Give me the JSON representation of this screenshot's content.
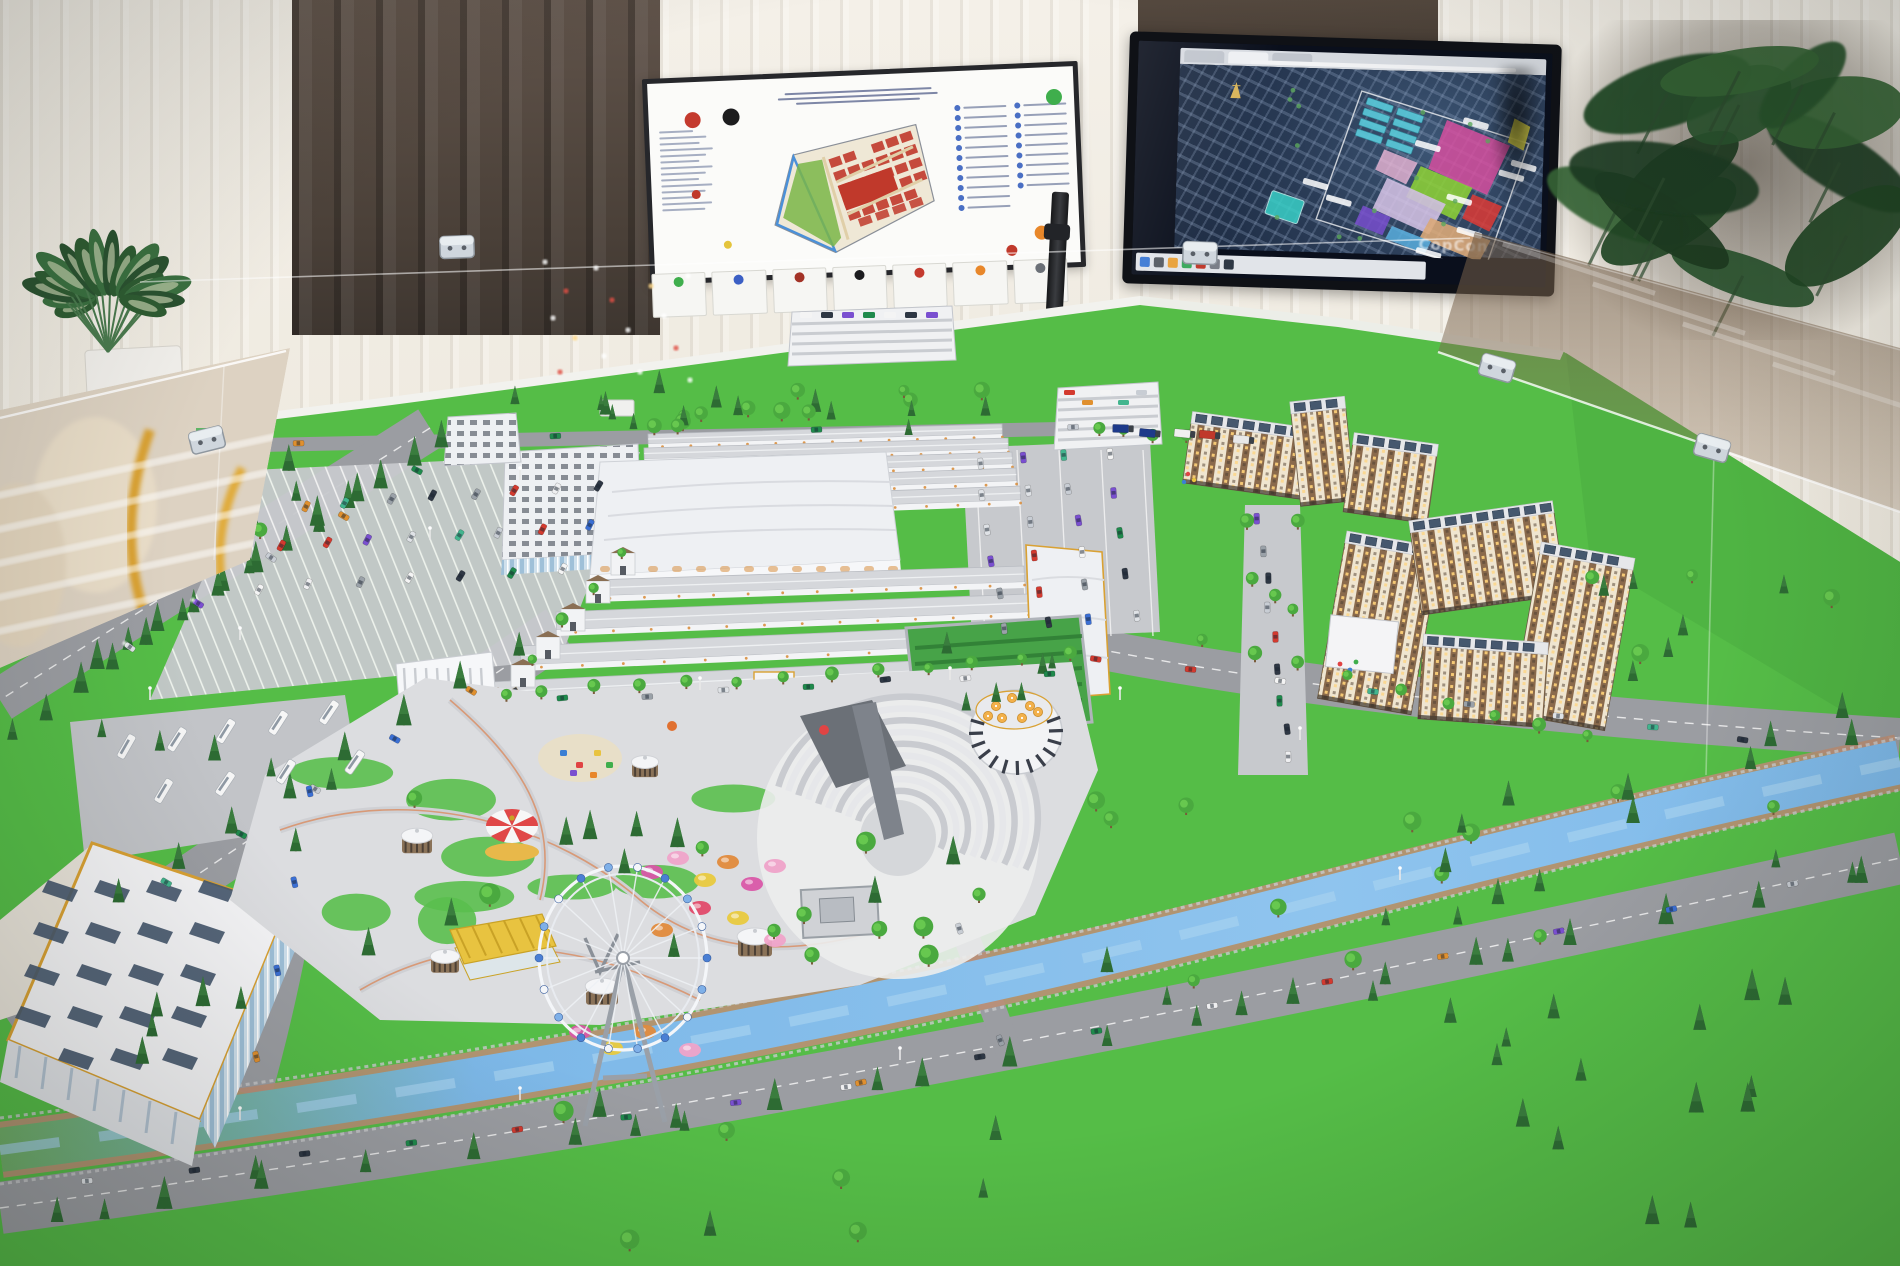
{
  "scene": {
    "subject": "Architectural scale model of a large bazaar / market complex with amusement park, apartment blocks and office building, displayed on a table behind glass barriers",
    "setting": "Showroom with cream pleated curtains, a brown drape, a printed master-plan board on an easel and a TV showing an aerial master plan"
  },
  "colors": {
    "grass": "#55bd47",
    "grassDark": "#3f9e3c",
    "rim": "#f2f2ed",
    "road": "#9b9da2",
    "roadLight": "#b2b4b8",
    "pave": "#dcdde0",
    "canal": "#7db8e8",
    "canalLight": "#aondefined",
    "canalHi": "#a8d2f0",
    "canalWall": "#bb8f75",
    "roof": "#d5d7db",
    "roofEdge": "#b9bcc2",
    "hall": "#eef0f3",
    "aptCream": "#efe5d0",
    "aptBrown": "#8a6a4c",
    "windowLit": "#ffd37a",
    "solar": "#46586e",
    "treeRound": "#4aa93f",
    "treeConifer": "#2d6b33",
    "gold": "#d9a133",
    "umbrella": "#f2b04a",
    "fence": "#c9ccd2",
    "archAccent": "#d98f3f"
  },
  "board": {
    "title_line_widths": [
      210,
      228,
      178
    ],
    "stamps": {
      "red": "#c43a2e",
      "black": "#1c1c1e",
      "green": "#3fae4c",
      "orange": "#e8872a",
      "yellow": "#e4c43c",
      "small_red": "#c0392b"
    },
    "left_text_rows": 14,
    "legend_rows_left": 11,
    "legend_rows_right": 9,
    "cards": [
      {
        "dot": "#3fae4c"
      },
      {
        "dot": "#3b5fc4"
      },
      {
        "dot": "#a33327"
      },
      {
        "dot": "#1c1c1e"
      },
      {
        "dot": "#c43a2e"
      },
      {
        "dot": "#e8872a"
      },
      {
        "dot": "#6b7077"
      }
    ],
    "siteplan": {
      "site_fill": "#efe8d6",
      "park_green": "#7ab648",
      "blocks_red": "#c0392b",
      "canal_blue": "#4a90d9",
      "road_tan": "#e0cfa8"
    }
  },
  "tv": {
    "watermark": "CopCon",
    "tabs": 3,
    "landmark_gold": "#d8b45a",
    "highlight": "#39d0c8",
    "taskbar_icons": [
      "#3b78d4",
      "#565b63",
      "#e8a13b",
      "#3aa85c",
      "#c0392b",
      "#7a7f88",
      "#2e3744"
    ],
    "zone_colors": {
      "traderow_teal": "#5ac8d8",
      "magenta": "#d94fa0",
      "lime": "#8fd435",
      "red": "#e03a34",
      "lavender": "#dcc8ea",
      "tan": "#e8b07a",
      "purple": "#7a4fd0",
      "skyblue": "#5ab0e0",
      "yellow": "#e8e04a",
      "pink": "#efb8d8"
    },
    "label_chips": 9
  },
  "model": {
    "areas": [
      "market trade rows",
      "exhibition halls",
      "multi-storey parking",
      "apartment blocks with solar roofs",
      "kindergarten",
      "amusement park",
      "ferris wheel",
      "amphitheatre",
      "rotunda cafe",
      "carousel",
      "yellow pavilion",
      "gazebos",
      "playground",
      "substation",
      "hedge garden",
      "shopping street",
      "office building",
      "canal",
      "boulevards",
      "parking lots"
    ],
    "car_palette": [
      "#f4f4f4",
      "#dfe2e6",
      "#d33a2f",
      "#2e3744",
      "#3b6fd4",
      "#42b58e",
      "#7a4fd0",
      "#e0902f",
      "#9aa1a8",
      "#1f8a4c",
      "#c8cdd4",
      "#efeff1"
    ],
    "truck_palette": [
      "#2e5fd4",
      "#e8e8e8",
      "#1d3a8a",
      "#c0392b",
      "#f0f0f0"
    ],
    "tree_zones": [
      {
        "x": 390,
        "y": 392,
        "w": 700,
        "h": 44,
        "n": 26,
        "t": "mix",
        "s": 9,
        "seed": 11
      },
      {
        "x": 160,
        "y": 430,
        "w": 210,
        "h": 120,
        "n": 9,
        "t": "mix",
        "s": 10,
        "seed": 21
      },
      {
        "x": 290,
        "y": 770,
        "w": 720,
        "h": 200,
        "n": 22,
        "t": "mix",
        "s": 11,
        "seed": 31
      },
      {
        "x": 915,
        "y": 632,
        "w": 150,
        "h": 82,
        "n": 6,
        "t": "con",
        "s": 9,
        "seed": 41
      },
      {
        "x": 1590,
        "y": 565,
        "w": 295,
        "h": 330,
        "n": 20,
        "t": "mix",
        "s": 10,
        "seed": 51
      },
      {
        "x": 1090,
        "y": 770,
        "w": 480,
        "h": 280,
        "n": 24,
        "t": "mix",
        "s": 10,
        "seed": 61
      },
      {
        "x": 1480,
        "y": 960,
        "w": 400,
        "h": 280,
        "n": 13,
        "t": "con",
        "s": 12,
        "seed": 71
      },
      {
        "x": 560,
        "y": 1090,
        "w": 520,
        "h": 160,
        "n": 11,
        "t": "mix",
        "s": 11,
        "seed": 81
      },
      {
        "x": 30,
        "y": 1000,
        "w": 260,
        "h": 220,
        "n": 7,
        "t": "con",
        "s": 11,
        "seed": 91
      },
      {
        "x": 1240,
        "y": 470,
        "w": 90,
        "h": 150,
        "n": 5,
        "t": "round",
        "s": 8,
        "seed": 101
      }
    ],
    "tree_rows": [
      {
        "x1": 445,
        "y1": 448,
        "x2": 95,
        "y2": 672,
        "n": 12,
        "t": "con",
        "s": 13
      },
      {
        "x1": 355,
        "y1": 500,
        "x2": 10,
        "y2": 742,
        "n": 11,
        "t": "con",
        "s": 12
      },
      {
        "x1": 520,
        "y1": 655,
        "x2": 120,
        "y2": 905,
        "n": 8,
        "t": "con",
        "s": 12
      },
      {
        "x1": 545,
        "y1": 698,
        "x2": 1068,
        "y2": 662,
        "n": 12,
        "t": "round",
        "s": 8
      },
      {
        "x1": 60,
        "y1": 1225,
        "x2": 880,
        "y2": 1092,
        "n": 9,
        "t": "con",
        "s": 13
      },
      {
        "x1": 920,
        "y1": 1085,
        "x2": 1850,
        "y2": 885,
        "n": 11,
        "t": "con",
        "s": 12
      },
      {
        "x1": 1205,
        "y1": 648,
        "x2": 1590,
        "y2": 742,
        "n": 9,
        "t": "round",
        "s": 8
      },
      {
        "x1": 100,
        "y1": 735,
        "x2": 330,
        "y2": 790,
        "n": 5,
        "t": "con",
        "s": 10
      },
      {
        "x1": 1098,
        "y1": 432,
        "x2": 1185,
        "y2": 442,
        "n": 4,
        "t": "round",
        "s": 7
      },
      {
        "x1": 620,
        "y1": 555,
        "x2": 505,
        "y2": 700,
        "n": 5,
        "t": "round",
        "s": 7
      }
    ],
    "car_strips": [
      {
        "x1": 305,
        "y1": 505,
        "x2": 600,
        "y2": 488,
        "n": 8,
        "a": -62,
        "k": "car"
      },
      {
        "x1": 282,
        "y1": 545,
        "x2": 588,
        "y2": 526,
        "n": 8,
        "a": -62,
        "k": "car"
      },
      {
        "x1": 258,
        "y1": 588,
        "x2": 560,
        "y2": 568,
        "n": 7,
        "a": -62,
        "k": "car"
      },
      {
        "x1": 415,
        "y1": 472,
        "x2": 130,
        "y2": 648,
        "n": 5,
        "a": 32,
        "k": "lit"
      },
      {
        "x1": 125,
        "y1": 748,
        "x2": 330,
        "y2": 714,
        "n": 5,
        "a": -58,
        "k": "bus"
      },
      {
        "x1": 162,
        "y1": 792,
        "x2": 352,
        "y2": 760,
        "n": 4,
        "a": -58,
        "k": "bus"
      },
      {
        "x1": 470,
        "y1": 692,
        "x2": 165,
        "y2": 882,
        "n": 5,
        "a": 31,
        "k": "car"
      },
      {
        "x1": 565,
        "y1": 700,
        "x2": 1048,
        "y2": 672,
        "n": 7,
        "a": -4,
        "k": "car"
      },
      {
        "x1": 978,
        "y1": 462,
        "x2": 1002,
        "y2": 628,
        "n": 6,
        "a": 82,
        "k": "car"
      },
      {
        "x1": 1022,
        "y1": 458,
        "x2": 1046,
        "y2": 624,
        "n": 6,
        "a": 82,
        "k": "car"
      },
      {
        "x1": 1066,
        "y1": 454,
        "x2": 1090,
        "y2": 620,
        "n": 6,
        "a": 82,
        "k": "car"
      },
      {
        "x1": 1110,
        "y1": 452,
        "x2": 1134,
        "y2": 616,
        "n": 5,
        "a": 82,
        "k": "car"
      },
      {
        "x1": 1258,
        "y1": 520,
        "x2": 1290,
        "y2": 758,
        "n": 9,
        "a": 86,
        "k": "car"
      },
      {
        "x1": 1095,
        "y1": 658,
        "x2": 1745,
        "y2": 738,
        "n": 8,
        "a": 7,
        "k": "car"
      },
      {
        "x1": 85,
        "y1": 1182,
        "x2": 845,
        "y2": 1088,
        "n": 8,
        "a": -7,
        "k": "car"
      },
      {
        "x1": 862,
        "y1": 1082,
        "x2": 1790,
        "y2": 882,
        "n": 9,
        "a": -12,
        "k": "car"
      },
      {
        "x1": 300,
        "y1": 442,
        "x2": 1075,
        "y2": 426,
        "n": 4,
        "a": -1,
        "k": "car"
      },
      {
        "x1": 1120,
        "y1": 428,
        "x2": 1240,
        "y2": 438,
        "n": 5,
        "a": 3,
        "k": "truck"
      },
      {
        "x1": 312,
        "y1": 792,
        "x2": 258,
        "y2": 1058,
        "n": 4,
        "a": 78,
        "k": "car"
      },
      {
        "x1": 958,
        "y1": 928,
        "x2": 1000,
        "y2": 1040,
        "n": 2,
        "a": 70,
        "k": "car"
      }
    ],
    "trade_rows_back": [
      [
        648,
        434,
        1002,
        424,
        10
      ],
      [
        644,
        448,
        1008,
        438,
        11
      ],
      [
        640,
        464,
        1012,
        452,
        12
      ],
      [
        634,
        482,
        1016,
        468,
        13
      ],
      [
        628,
        500,
        1020,
        486,
        14
      ]
    ],
    "trade_rows_front": [
      [
        592,
        580,
        1024,
        566,
        16
      ],
      [
        556,
        612,
        1028,
        594,
        18
      ],
      [
        520,
        646,
        1032,
        624,
        19
      ],
      [
        492,
        682,
        1036,
        655,
        20
      ]
    ],
    "apartment_slabs": [
      {
        "x": 1185,
        "y": 430,
        "w": 130,
        "h": 62,
        "r": 8,
        "cx": 1250,
        "cy": 470
      },
      {
        "x": 1295,
        "y": 408,
        "w": 55,
        "h": 95,
        "r": -6,
        "cx": 1330,
        "cy": 450
      },
      {
        "x": 1348,
        "y": 448,
        "w": 85,
        "h": 70,
        "r": 8,
        "cx": 1390,
        "cy": 480
      },
      {
        "x": 1332,
        "y": 548,
        "w": 95,
        "h": 160,
        "r": 10,
        "cx": 1380,
        "cy": 620
      },
      {
        "x": 1415,
        "y": 520,
        "w": 145,
        "h": 85,
        "r": -8,
        "cx": 1490,
        "cy": 560
      },
      {
        "x": 1525,
        "y": 560,
        "w": 95,
        "h": 165,
        "r": 10,
        "cx": 1580,
        "cy": 640
      },
      {
        "x": 1420,
        "y": 648,
        "w": 125,
        "h": 75,
        "r": 4,
        "cx": 1480,
        "cy": 690
      }
    ],
    "gazebos": [
      [
        417,
        845,
        15
      ],
      [
        445,
        965,
        14
      ],
      [
        602,
        996,
        16
      ],
      [
        755,
        947,
        17
      ],
      [
        645,
        770,
        13
      ]
    ],
    "flowers": [
      [
        652,
        872,
        "#d957a8"
      ],
      [
        678,
        858,
        "#efa3c9"
      ],
      [
        705,
        880,
        "#e8c93e"
      ],
      [
        728,
        862,
        "#e08a3c"
      ],
      [
        752,
        884,
        "#d957a8"
      ],
      [
        775,
        866,
        "#efa3c9"
      ],
      [
        700,
        908,
        "#e04a6a"
      ],
      [
        738,
        918,
        "#e8c93e"
      ],
      [
        662,
        930,
        "#e08a3c"
      ],
      [
        775,
        940,
        "#efa3c9"
      ],
      [
        580,
        1032,
        "#d957a8"
      ],
      [
        612,
        1048,
        "#e8c93e"
      ],
      [
        645,
        1032,
        "#e08a3c"
      ],
      [
        690,
        1050,
        "#efa3c9"
      ]
    ],
    "umbrellas_cafe": [
      [
        996,
        706
      ],
      [
        1012,
        698
      ],
      [
        1030,
        706
      ],
      [
        1002,
        718
      ],
      [
        1022,
        718
      ],
      [
        1038,
        712
      ],
      [
        988,
        716
      ]
    ],
    "umbrellas_office": [
      [
        22,
        896
      ],
      [
        44,
        882
      ],
      [
        66,
        868
      ],
      [
        30,
        930
      ],
      [
        52,
        916
      ],
      [
        74,
        902
      ],
      [
        38,
        964
      ],
      [
        60,
        950
      ]
    ],
    "lamps": [
      [
        240,
        640
      ],
      [
        150,
        700
      ],
      [
        430,
        540
      ],
      [
        520,
        480
      ],
      [
        700,
        690
      ],
      [
        950,
        680
      ],
      [
        1120,
        700
      ],
      [
        1300,
        740
      ],
      [
        520,
        1100
      ],
      [
        900,
        1060
      ],
      [
        1400,
        880
      ],
      [
        240,
        1120
      ]
    ],
    "bokeh": [
      [
        545,
        262,
        "#ffffff"
      ],
      [
        566,
        291,
        "#e05044"
      ],
      [
        553,
        318,
        "#ffffff"
      ],
      [
        575,
        338,
        "#ffd98a"
      ],
      [
        596,
        268,
        "#ffffff"
      ],
      [
        612,
        300,
        "#e05044"
      ],
      [
        628,
        330,
        "#ffffff"
      ],
      [
        604,
        356,
        "#ffffff"
      ],
      [
        651,
        286,
        "#ffd98a"
      ],
      [
        664,
        316,
        "#ffffff"
      ],
      [
        676,
        348,
        "#e05044"
      ],
      [
        688,
        276,
        "#ffffff"
      ],
      [
        640,
        372,
        "#ffffff"
      ],
      [
        560,
        372,
        "#e05044"
      ],
      [
        690,
        380,
        "#ffffff"
      ]
    ],
    "ferris": {
      "cx": 623,
      "cy": 958,
      "rx": 84,
      "ry": 92,
      "spokes": 18,
      "cabins": [
        "#4a7fd4",
        "#7fb0e8",
        "#f4f6f9"
      ]
    },
    "amphitheatre": {
      "cx": 898,
      "cy": 838,
      "r0": 44,
      "r1": 132,
      "step": 11,
      "a0": 205,
      "a1": 375
    }
  }
}
